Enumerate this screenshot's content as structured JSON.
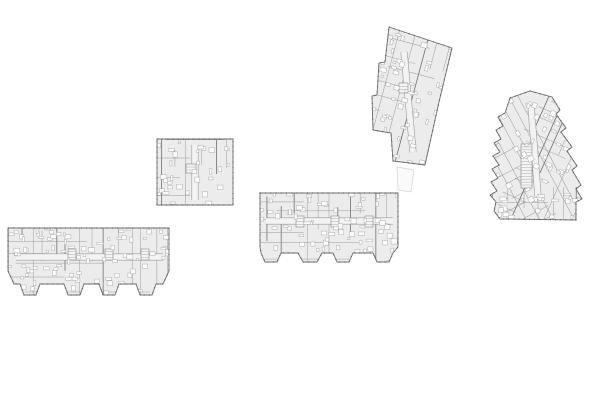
{
  "canvas": {
    "width": 600,
    "height": 400,
    "background": "#ffffff"
  },
  "palette": {
    "paper": "#ffffff",
    "floor_fill": "#ececec",
    "wall_stroke": "#6f6f6f",
    "partition_stroke": "#9a9a9a",
    "corridor_fill": "#f3f3f3",
    "furniture_fill": "#fbfbfb",
    "furniture_stroke": "#a6a6a6",
    "core_fill": "#f4f4f4",
    "core_stroke": "#8a8a8a",
    "tick_stroke": "#585858",
    "faint_stroke": "#d2d2d2",
    "faint_fill": "#fafafa"
  },
  "annex": {
    "id": "link-annex",
    "outline": [
      [
        397,
        167
      ],
      [
        414,
        170
      ],
      [
        411,
        192
      ],
      [
        398,
        190
      ]
    ]
  },
  "plans": [
    {
      "id": "slab-west",
      "outline": [
        [
          8,
          228
        ],
        [
          169,
          228
        ],
        [
          169,
          271
        ],
        [
          163,
          284
        ],
        [
          156,
          284
        ],
        [
          152,
          295
        ],
        [
          140,
          295
        ],
        [
          136,
          284
        ],
        [
          119,
          284
        ],
        [
          115,
          295
        ],
        [
          103,
          295
        ],
        [
          99,
          284
        ],
        [
          84,
          284
        ],
        [
          80,
          295
        ],
        [
          68,
          295
        ],
        [
          64,
          284
        ],
        [
          40,
          284
        ],
        [
          36,
          295
        ],
        [
          24,
          295
        ],
        [
          20,
          284
        ],
        [
          14,
          284
        ],
        [
          8,
          271
        ]
      ],
      "zones": [
        {
          "angle": 0,
          "x": 8,
          "y": 228,
          "w": 161,
          "h": 67
        }
      ],
      "corridors": [
        [
          16,
          257,
          163,
          257
        ]
      ],
      "cores": [
        [
          68,
          249,
          8,
          11
        ],
        [
          105,
          249,
          8,
          11
        ],
        [
          141,
          249,
          8,
          11
        ]
      ],
      "partition_spacing": 11,
      "furniture_count": 85,
      "seed": 11
    },
    {
      "id": "block-north",
      "outline": [
        [
          157,
          139
        ],
        [
          233,
          139
        ],
        [
          233,
          205
        ],
        [
          157,
          205
        ]
      ],
      "zones": [
        {
          "angle": 0,
          "x": 157,
          "y": 139,
          "w": 76,
          "h": 66
        }
      ],
      "corridors": [
        [
          195,
          145,
          195,
          200
        ]
      ],
      "cores": [
        [
          186,
          164,
          10,
          9
        ]
      ],
      "partition_spacing": 12,
      "furniture_count": 32,
      "seed": 23
    },
    {
      "id": "slab-center",
      "outline": [
        [
          260,
          193
        ],
        [
          398,
          193
        ],
        [
          398,
          247
        ],
        [
          393,
          253
        ],
        [
          389,
          262
        ],
        [
          377,
          262
        ],
        [
          373,
          253
        ],
        [
          353,
          253
        ],
        [
          349,
          262
        ],
        [
          337,
          262
        ],
        [
          333,
          253
        ],
        [
          322,
          253
        ],
        [
          317,
          262
        ],
        [
          303,
          262
        ],
        [
          298,
          253
        ],
        [
          281,
          253
        ],
        [
          277,
          262
        ],
        [
          265,
          262
        ],
        [
          261,
          253
        ],
        [
          260,
          247
        ]
      ],
      "zones": [
        {
          "angle": 0,
          "x": 260,
          "y": 193,
          "w": 138,
          "h": 69
        }
      ],
      "corridors": [
        [
          266,
          221,
          393,
          221
        ]
      ],
      "cores": [
        [
          296,
          216,
          8,
          11
        ],
        [
          331,
          216,
          8,
          11
        ],
        [
          365,
          216,
          8,
          11
        ]
      ],
      "partition_spacing": 11,
      "furniture_count": 70,
      "seed": 37
    },
    {
      "id": "bar-northeast",
      "outline": [
        [
          389,
          27
        ],
        [
          452,
          48
        ],
        [
          439,
          102
        ],
        [
          425,
          165
        ],
        [
          393,
          161
        ],
        [
          391,
          133
        ],
        [
          373,
          130
        ],
        [
          372,
          96
        ],
        [
          377,
          95
        ],
        [
          379,
          63
        ],
        [
          385,
          62
        ]
      ],
      "zones": [
        {
          "angle": 15,
          "x": 371,
          "y": 26,
          "w": 81,
          "h": 140
        }
      ],
      "corridors": [
        [
          404,
          52,
          413,
          152
        ]
      ],
      "cores": [
        [
          399,
          83,
          9,
          10
        ]
      ],
      "partition_spacing": 11,
      "furniture_count": 50,
      "seed": 51
    },
    {
      "id": "point-block-east",
      "outline": [
        [
          510,
          98
        ],
        [
          530,
          91
        ],
        [
          552,
          97
        ],
        [
          560,
          110
        ],
        [
          556,
          114
        ],
        [
          566,
          128
        ],
        [
          561,
          132
        ],
        [
          572,
          147
        ],
        [
          567,
          151
        ],
        [
          577,
          166
        ],
        [
          572,
          170
        ],
        [
          581,
          185
        ],
        [
          576,
          189
        ],
        [
          582,
          199
        ],
        [
          576,
          202
        ],
        [
          576,
          220
        ],
        [
          500,
          219
        ],
        [
          494,
          211
        ],
        [
          496,
          202
        ],
        [
          490,
          195
        ],
        [
          497,
          191
        ],
        [
          491,
          182
        ],
        [
          498,
          178
        ],
        [
          492,
          169
        ],
        [
          499,
          165
        ],
        [
          493,
          156
        ],
        [
          500,
          152
        ],
        [
          494,
          143
        ],
        [
          501,
          139
        ],
        [
          496,
          130
        ],
        [
          503,
          126
        ],
        [
          498,
          117
        ],
        [
          505,
          113
        ]
      ],
      "zones": [
        {
          "angle": -28,
          "x": 486,
          "y": 96,
          "w": 46,
          "h": 118
        },
        {
          "angle": 24,
          "x": 528,
          "y": 94,
          "w": 56,
          "h": 110
        },
        {
          "angle": 0,
          "x": 496,
          "y": 194,
          "w": 84,
          "h": 28
        }
      ],
      "corridors": [
        [
          531,
          105,
          538,
          196
        ]
      ],
      "cores": [
        [
          521,
          144,
          11,
          44
        ]
      ],
      "partition_spacing": 11,
      "furniture_count": 58,
      "seed": 67
    }
  ]
}
